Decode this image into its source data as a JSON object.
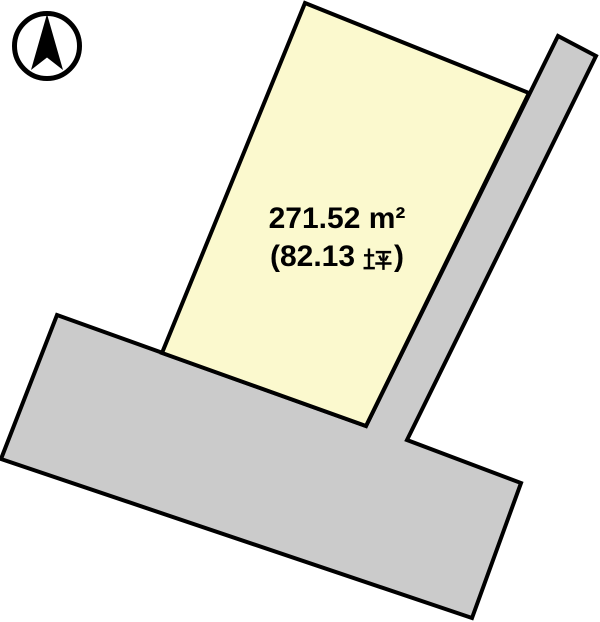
{
  "compass": {
    "icon": "north-arrow"
  },
  "parcel": {
    "area_m2": "271.52 m²",
    "area_tsubo": "(82.13 坪)",
    "area_tsubo_prefix": "(82.13",
    "area_tsubo_unit_kanji": "坪",
    "area_tsubo_suffix": ")",
    "fill": "#FBF9CE"
  },
  "road": {
    "fill": "#CBCBCB"
  },
  "colors": {
    "outline": "#000000",
    "background": "#FFFFFF",
    "text": "#000000"
  }
}
